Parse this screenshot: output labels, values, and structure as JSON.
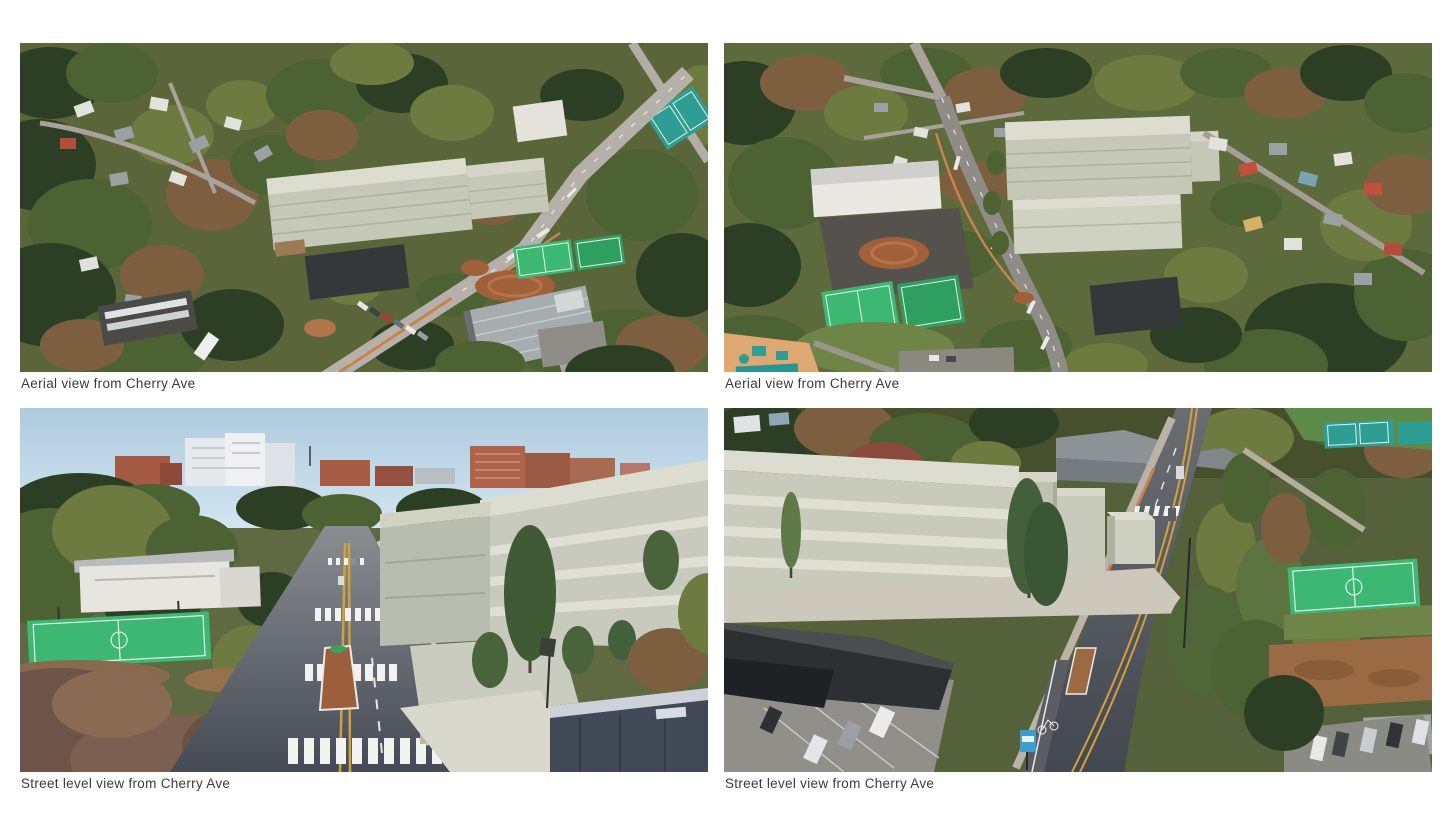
{
  "page": {
    "background": "#ffffff",
    "caption_color": "#3a3a3a"
  },
  "figures": [
    {
      "id": "aerial-left",
      "caption": "Aerial view from Cherry Ave",
      "alt": "Aerial 3D rendering: white building massing beside diagonal Cherry Ave, courts and warehouse at right"
    },
    {
      "id": "aerial-right",
      "caption": "Aerial view from Cherry Ave",
      "alt": "Aerial 3D rendering: two white massing blocks along Cherry Ave with park, courts and playground at left"
    },
    {
      "id": "street-left",
      "caption": "Street level view from Cherry Ave",
      "alt": "Street level rendering looking along Cherry Ave with massing building on right and courts on left"
    },
    {
      "id": "street-right",
      "caption": "Street level view from Cherry Ave",
      "alt": "Street level rendering with large massing building on left and Cherry Ave receding to the right"
    }
  ],
  "colors": {
    "massing": "#c6c8b7",
    "massing_roof": "#dcddcf",
    "court_green": "#3cb873",
    "tennis_teal": "#2e9e94",
    "infield_clay": "#a2603a",
    "asphalt": "#4e535a",
    "sky": "#b3cfe2"
  }
}
